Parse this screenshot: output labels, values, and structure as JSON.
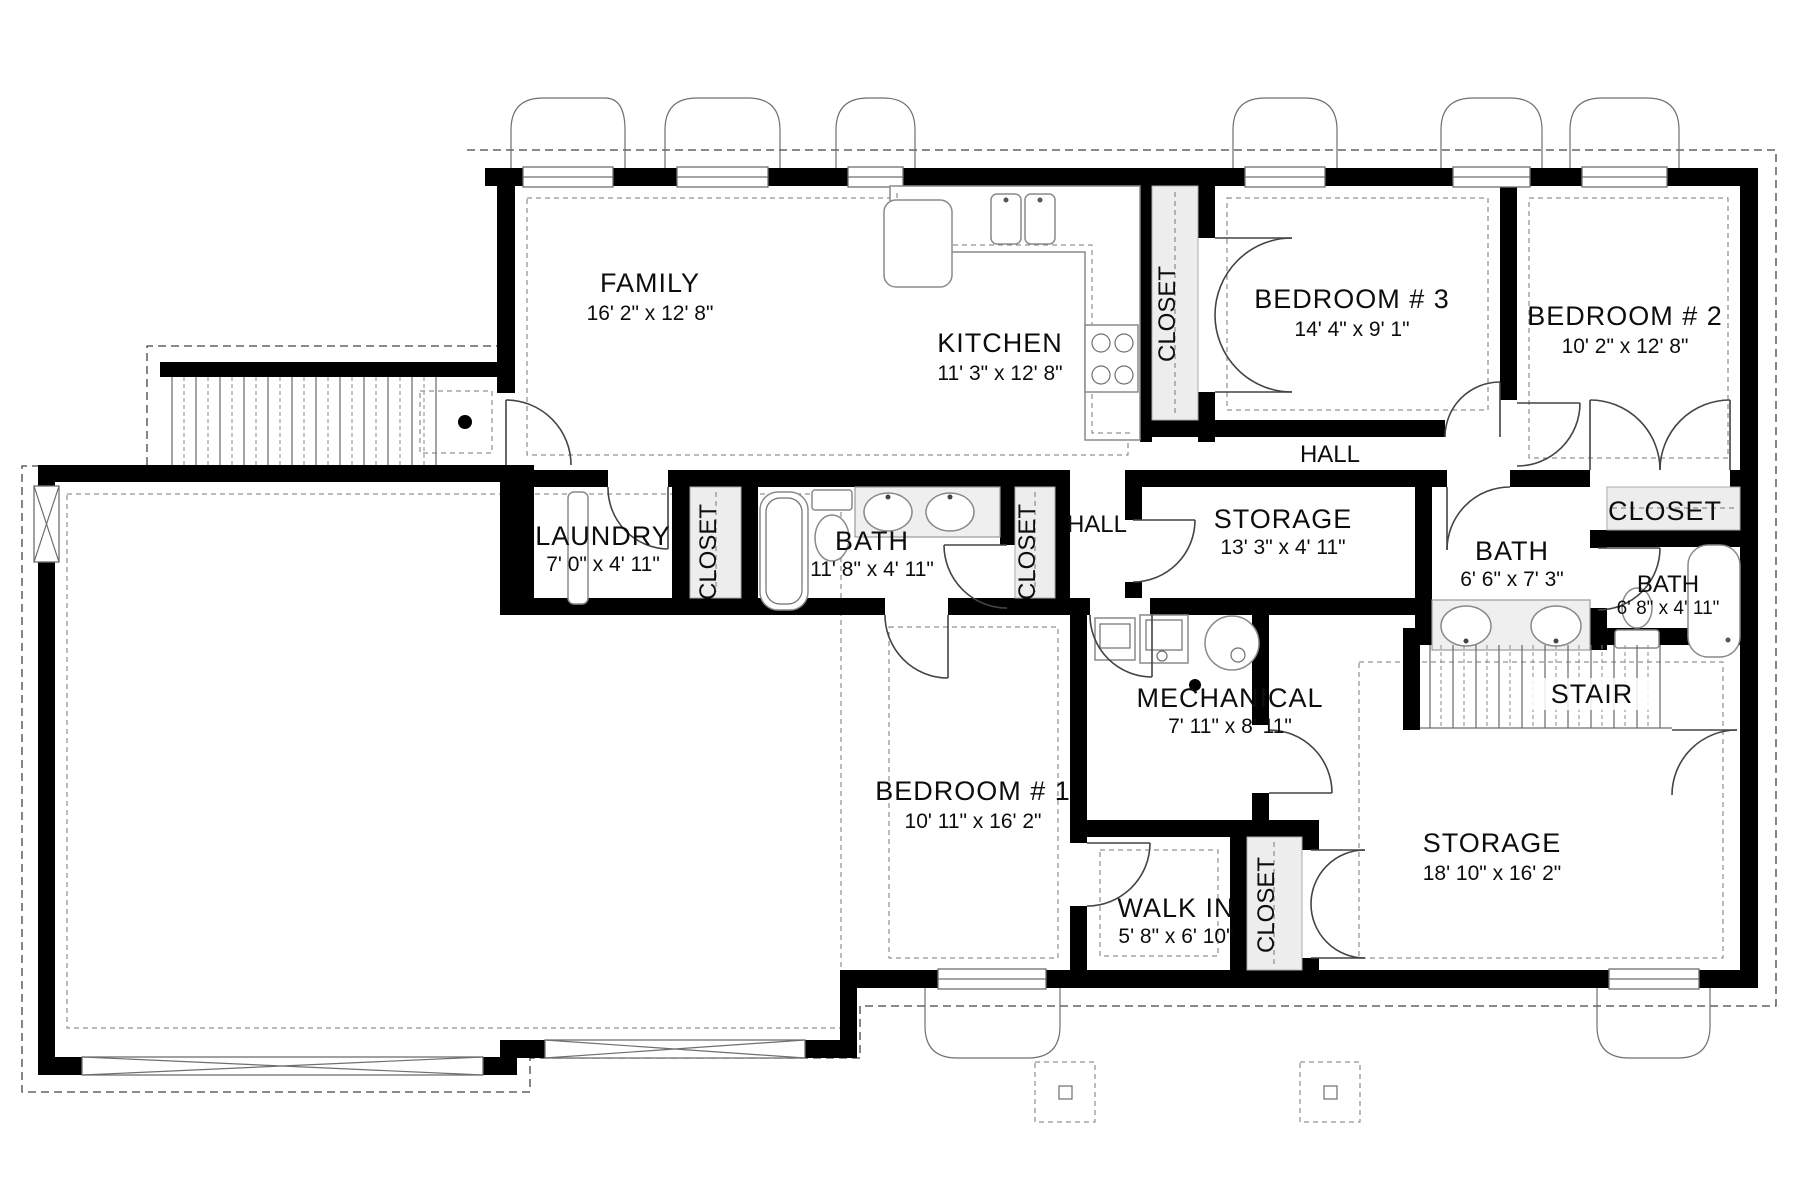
{
  "plan": {
    "title": "Basement floor plan",
    "rooms": [
      {
        "name": "FAMILY",
        "dims": "16' 2\" x 12' 8\""
      },
      {
        "name": "KITCHEN",
        "dims": "11' 3\" x 12' 8\""
      },
      {
        "name": "BEDROOM # 3",
        "dims": "14' 4\" x 9' 1\""
      },
      {
        "name": "BEDROOM # 2",
        "dims": "10' 2\" x 12' 8\""
      },
      {
        "name": "LAUNDRY",
        "dims": "7' 0\" x 4' 11\""
      },
      {
        "name": "BATH",
        "dims": "11' 8\" x 4' 11\""
      },
      {
        "name": "STORAGE",
        "dims": "13' 3\" x 4' 11\""
      },
      {
        "name": "BATH",
        "dims": "6' 6\" x 7' 3\""
      },
      {
        "name": "BATH",
        "dims": "6' 8\" x 4' 11\""
      },
      {
        "name": "MECHANICAL",
        "dims": "7' 11\" x 8' 11\""
      },
      {
        "name": "BEDROOM # 1",
        "dims": "10' 11\" x 16' 2\""
      },
      {
        "name": "WALK IN",
        "dims": "5' 8\" x 6' 10\""
      },
      {
        "name": "STORAGE",
        "dims": "18' 10\" x 16' 2\""
      }
    ],
    "labels": {
      "hall": "HALL",
      "stair": "STAIR",
      "closet": "CLOSET"
    },
    "colors": {
      "wall": "#000000",
      "background": "#ffffff",
      "closet_fill": "#ededed",
      "line": "#444444"
    }
  }
}
